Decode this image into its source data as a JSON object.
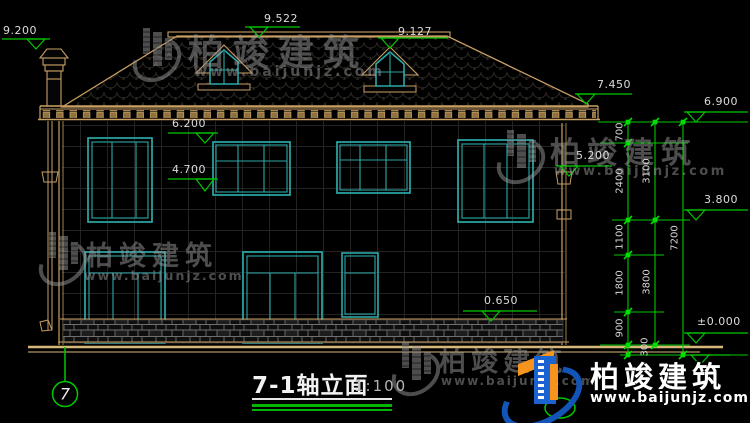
{
  "title": {
    "name": "7-1轴立面",
    "scale": "1:100"
  },
  "axis": {
    "bubble": "7"
  },
  "elevations": {
    "chimney_top": "9.200",
    "main_ridge": "9.522",
    "secondary_ridge": "9.127",
    "eave": "7.450",
    "cornice": "6.900",
    "floor2_window_head": "6.200",
    "right_window_head": "5.200",
    "floor2_window_sill": "4.700",
    "floor2_level": "3.800",
    "plinth_top": "0.650",
    "ground": "±0.000"
  },
  "dimensions": {
    "seg_700": "700",
    "seg_2400": "2400",
    "seg_1100": "1100",
    "seg_1800": "1800",
    "seg_900": "900",
    "seg_300": "300",
    "sub_3100": "3100",
    "sub_3800": "3800",
    "total_7200": "7200"
  },
  "watermark": {
    "brand": "柏竣建筑",
    "url": "www.baijunjz.com"
  },
  "logo": {
    "brand": "柏竣建筑",
    "url": "www.baijunjz.com"
  }
}
